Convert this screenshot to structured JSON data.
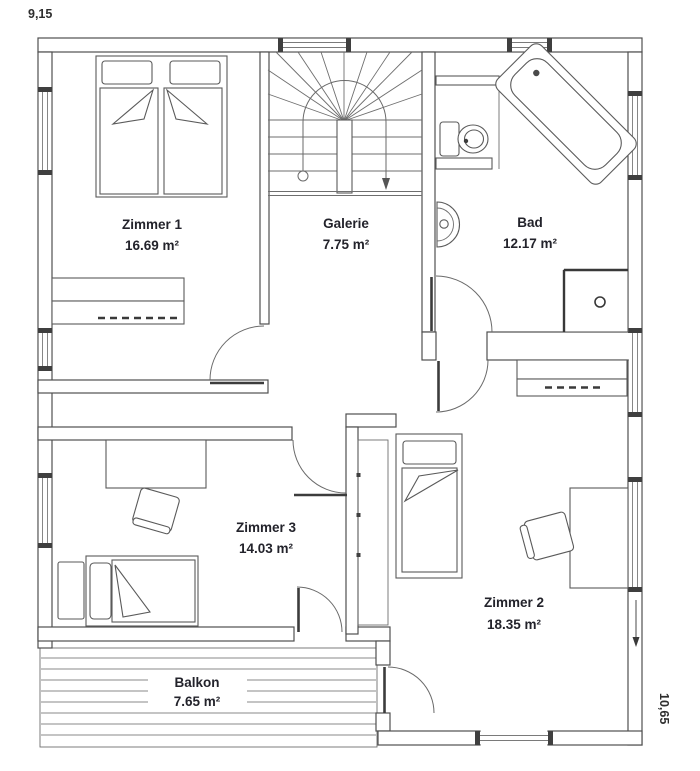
{
  "plan": {
    "type": "floor-plan",
    "floor": "upper-floor",
    "background": "#ffffff"
  },
  "dimensions": {
    "width_label": "9,15",
    "height_label": "10,65"
  },
  "rooms": [
    {
      "name": "Zimmer 1",
      "area": "16.69 m²"
    },
    {
      "name": "Galerie",
      "area": "7.75 m²"
    },
    {
      "name": "Bad",
      "area": "12.17 m²"
    },
    {
      "name": "Zimmer 3",
      "area": "14.03 m²"
    },
    {
      "name": "Zimmer 2",
      "area": "18.35 m²"
    },
    {
      "name": "Balkon",
      "area": "7.65 m²"
    }
  ],
  "fixtures": [
    "staircase",
    "walking-line",
    "double-bed",
    "single-bed",
    "wardrobe",
    "closet",
    "desk",
    "chair",
    "side-table",
    "bathtub",
    "toilet",
    "washbasin",
    "shower",
    "balcony-decking",
    "door-swing"
  ],
  "colors": {
    "wall_line": "#4f4f4f",
    "thin_line": "#6e6e6e",
    "text": "#23232b",
    "background": "#ffffff"
  }
}
